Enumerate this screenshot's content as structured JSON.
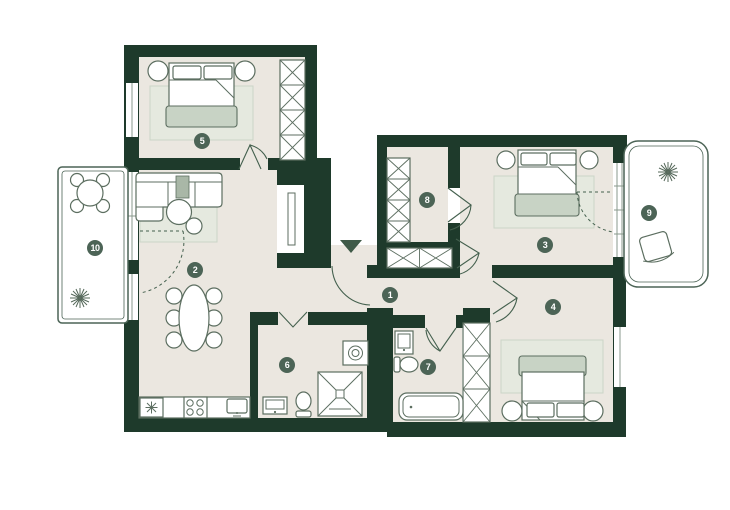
{
  "floorplan": {
    "rooms": [
      {
        "number": "1"
      },
      {
        "number": "2"
      },
      {
        "number": "3"
      },
      {
        "number": "4"
      },
      {
        "number": "5"
      },
      {
        "number": "6"
      },
      {
        "number": "7"
      },
      {
        "number": "8"
      },
      {
        "number": "9"
      },
      {
        "number": "10"
      }
    ],
    "colors": {
      "wall": "#1e3a2b",
      "floor": "#ebe7e0",
      "rug": "#e5e9df",
      "textile": "#c8d3c5",
      "badge_background": "#4c6456",
      "badge_text": "#ffffff",
      "outline": "#5c6e60",
      "balcony_floor": "#ffffff"
    },
    "icons": {
      "entrance_arrow": "down-triangle",
      "fridge_symbol": "snowflake-asterisk",
      "plants": "branch-star",
      "wardrobes": "x-hatch-shelving",
      "shower": "x-square",
      "washing_machine": "square-with-drum-circle"
    }
  }
}
